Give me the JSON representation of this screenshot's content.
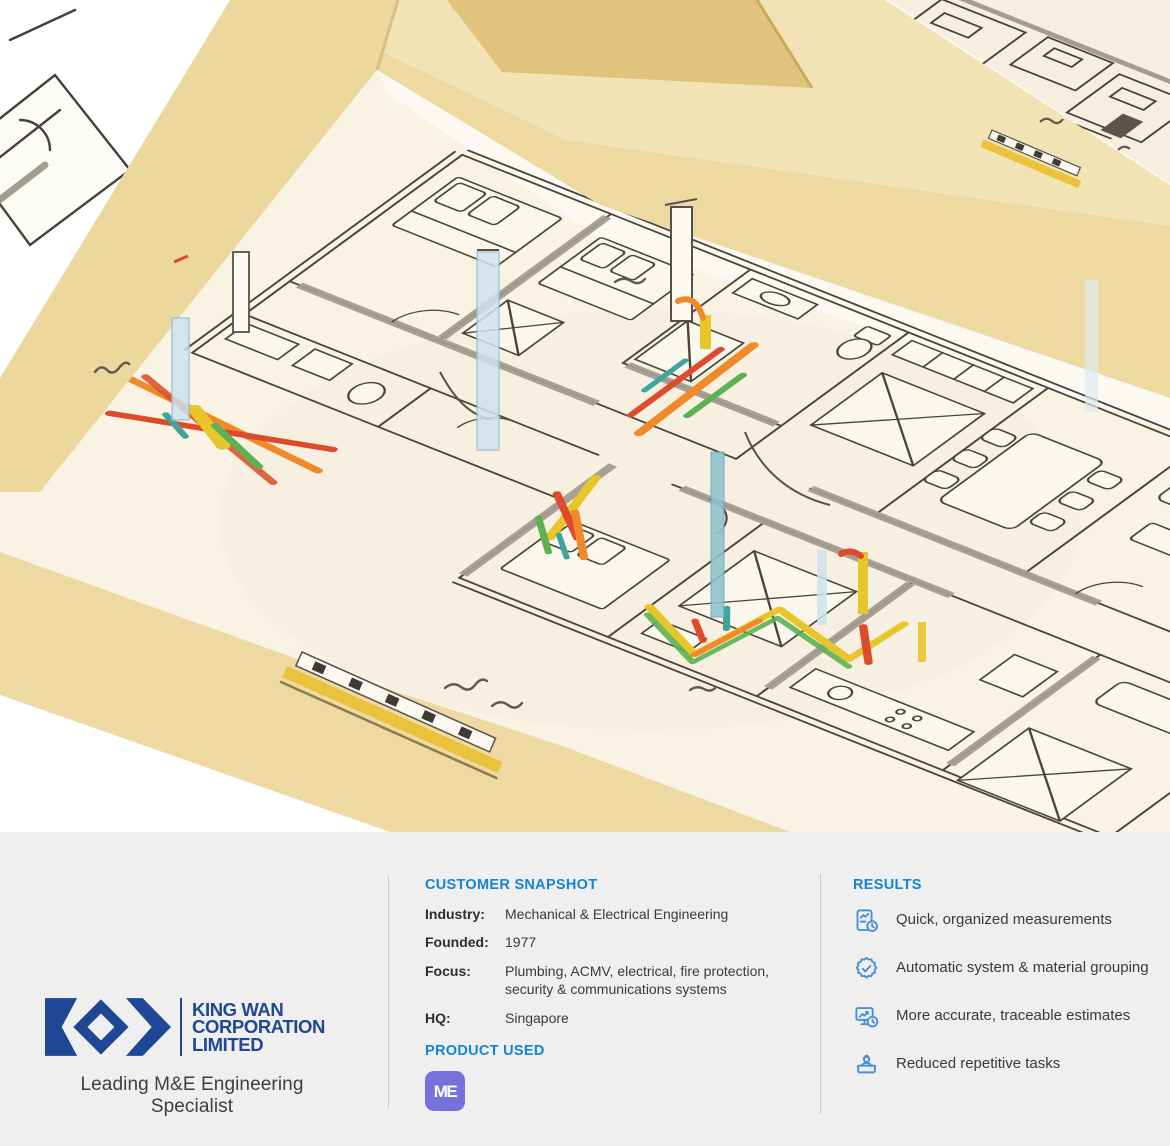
{
  "brand": {
    "logo_lines": [
      "KING WAN",
      "CORPORATION",
      "LIMITED"
    ],
    "tagline": "Leading M&E Engineering Specialist"
  },
  "snapshot": {
    "heading": "CUSTOMER SNAPSHOT",
    "fields": [
      {
        "label": "Industry:",
        "value": "Mechanical & Electrical Engineering"
      },
      {
        "label": "Founded:",
        "value": "1977"
      },
      {
        "label": "Focus:",
        "value": "Plumbing, ACMV, electrical, fire protection, security & communications systems"
      },
      {
        "label": "HQ:",
        "value": "Singapore"
      }
    ],
    "product_heading": "PRODUCT USED",
    "product_badge": "ME"
  },
  "results": {
    "heading": "RESULTS",
    "items": [
      {
        "icon": "measurement-report-icon",
        "text": "Quick, organized measurements"
      },
      {
        "icon": "badge-check-icon",
        "text": "Automatic system & material grouping"
      },
      {
        "icon": "estimate-monitor-icon",
        "text": "More accurate, traceable estimates"
      },
      {
        "icon": "worker-board-icon",
        "text": "Reduced repetitive tasks"
      }
    ]
  },
  "illustration": {
    "name": "isometric-floorplan-sketch",
    "colors": {
      "tan_wall": "#ecd79c",
      "tan_band": "#eed9a0",
      "floor_cream": "#f9f3e4",
      "sketch_line": "#4a443b",
      "wall_gray": "#a49c90",
      "pipe_red": "#dd4a2c",
      "pipe_orange": "#f08a28",
      "pipe_yellow": "#e8c52a",
      "pipe_green": "#5cb150",
      "pipe_teal": "#3fa49b",
      "riser_blue": "#cfe3ef"
    }
  },
  "theme": {
    "panel_bg": "#efeff0",
    "accent_blue": "#1583d6",
    "logo_navy": "#1f4795",
    "badge_purple": "#7672db",
    "icon_blue": "#4a90d6",
    "text_dark": "#39393b",
    "divider": "#c9c9cb"
  }
}
